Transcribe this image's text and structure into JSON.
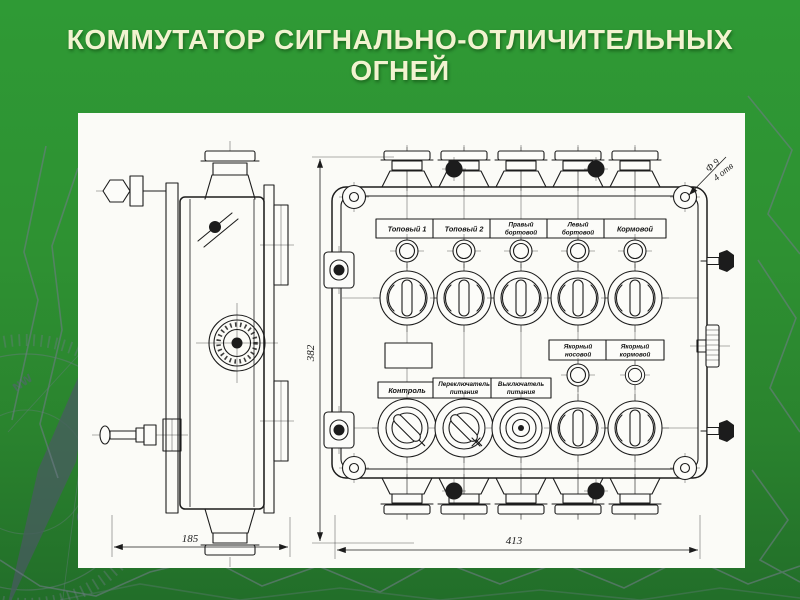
{
  "slide": {
    "title_line1": "КОММУТАТОР СИГНАЛЬНО-ОТЛИЧИТЕЛЬНЫХ",
    "title_line2": "ОГНЕЙ",
    "colors": {
      "background": "#2e9132",
      "title_text": "#f2f3d0",
      "panel_background": "#fbfbf7",
      "drawing_ink": "#1c1c1c",
      "decor_gray": "#6e7c85"
    },
    "decor": {
      "compass_south_label": "S",
      "compass_nw_label": "NW"
    }
  },
  "drawing": {
    "labels_top": [
      {
        "line1": "Топовый 1"
      },
      {
        "line1": "Топовый 2"
      },
      {
        "line1": "Правый",
        "line2": "бортовой"
      },
      {
        "line1": "Левый",
        "line2": "бортовой"
      },
      {
        "line1": "Кормовой"
      }
    ],
    "labels_mid": [
      {
        "line1": "Якорный",
        "line2": "носовой"
      },
      {
        "line1": "Якорный",
        "line2": "кормовой"
      }
    ],
    "labels_bottom": [
      {
        "line1": "Контроль"
      },
      {
        "line1": "Переключатель",
        "line2": "питания"
      },
      {
        "line1": "Выключатель",
        "line2": "питания"
      }
    ],
    "dimensions": {
      "side_width": "185",
      "front_width": "413",
      "front_height": "382",
      "hole_dia": "Ф 9",
      "hole_count": "4 отв"
    }
  }
}
